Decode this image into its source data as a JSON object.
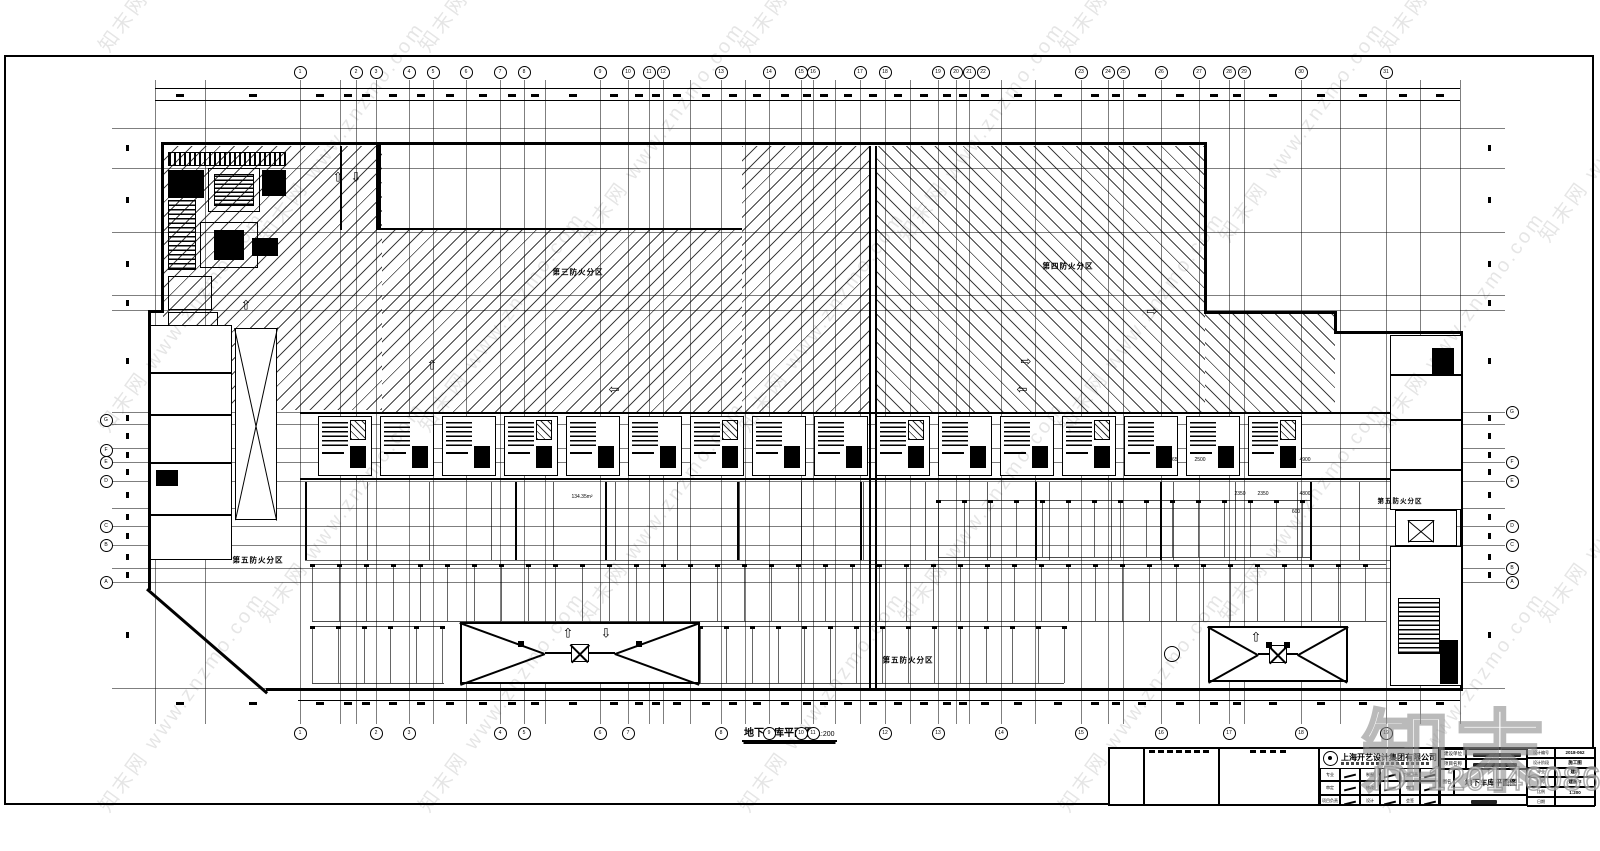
{
  "watermark": {
    "tile_text": "知末网 www.znzmo.com",
    "brand": "知末",
    "id_label": "ID: 1201460866"
  },
  "drawing": {
    "title": "地下车库平面图",
    "scale": "1:200",
    "zone_labels": {
      "zone3": "第三防火分区",
      "zone4": "第四防火分区",
      "zone5": "第五防火分区"
    },
    "small_labels": [
      "134.35m²",
      "2350",
      "2350",
      "4800",
      "600",
      "1765",
      "2500",
      "4900"
    ],
    "axis_top": [
      "1",
      "2",
      "3",
      "4",
      "5",
      "6",
      "7",
      "8",
      "9",
      "10",
      "11",
      "12",
      "13",
      "14",
      "15",
      "16",
      "17",
      "18",
      "19",
      "20",
      "21",
      "22",
      "23",
      "24",
      "25",
      "26",
      "27",
      "28",
      "29",
      "30",
      "31"
    ],
    "axis_bottom": [
      "1",
      "2",
      "3",
      "4",
      "5",
      "6",
      "7",
      "8",
      "9",
      "10",
      "11",
      "12",
      "13",
      "14",
      "15",
      "16",
      "17",
      "18",
      "19"
    ],
    "axis_left": [
      "G",
      "F",
      "E",
      "D",
      "C",
      "B",
      "A"
    ],
    "axis_right": [
      "G",
      "F",
      "E",
      "D",
      "C",
      "B",
      "A"
    ]
  },
  "title_block": {
    "company": "上海开艺设计集团有限公司",
    "sign_grid": [
      [
        "专业",
        "制图",
        "专业负责"
      ],
      [
        "审定",
        "修改",
        "审核"
      ],
      [
        "项目负责",
        "设计",
        "会签"
      ]
    ],
    "info_rows": [
      {
        "label": "建设单位"
      },
      {
        "label": "项目名称"
      }
    ],
    "name_label": "图名",
    "drawing_name": "地下车库平面图",
    "right_fields": [
      {
        "label": "设计编号",
        "value": "2018-062"
      },
      {
        "label": "设计阶段",
        "value": "施工图"
      },
      {
        "label": "专业",
        "value": "建筑"
      },
      {
        "label": "图号",
        "value": "建施-2"
      },
      {
        "label": "比例",
        "value": "1:200"
      },
      {
        "label": "日期",
        "value": ""
      }
    ]
  }
}
